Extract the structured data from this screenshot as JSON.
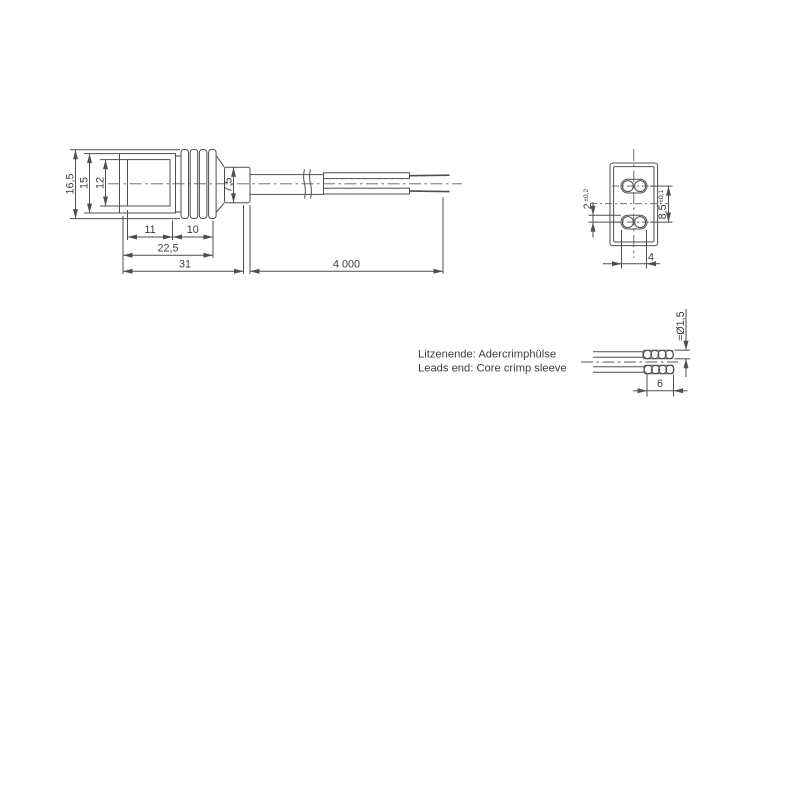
{
  "meta": {
    "type": "technical-drawing-connector-with-cable",
    "background": "#ffffff",
    "line_color": "#4f4f4f",
    "text_color": "#3d3d3d"
  },
  "side_view": {
    "overall_height": "16,5",
    "body_height": "15",
    "inner_height": "12",
    "gland_diameter": "7,5",
    "body_length": "11",
    "ribs_length": "10",
    "front_length": "22,5",
    "total_length": "31",
    "cable_length": "4 000"
  },
  "front_view": {
    "slot_height": "2",
    "slot_height_tol": "±0,2",
    "contact_pitch": "8,5",
    "contact_pitch_tol": "±0,1",
    "contact_spacing": "4"
  },
  "crimp_detail": {
    "sleeve_diameter": "≈Ø1,5",
    "sleeve_length": "6"
  },
  "notes": {
    "line1": "Litzenende: Adercrimphülse",
    "line2": "Leads end: Core crimp sleeve"
  }
}
